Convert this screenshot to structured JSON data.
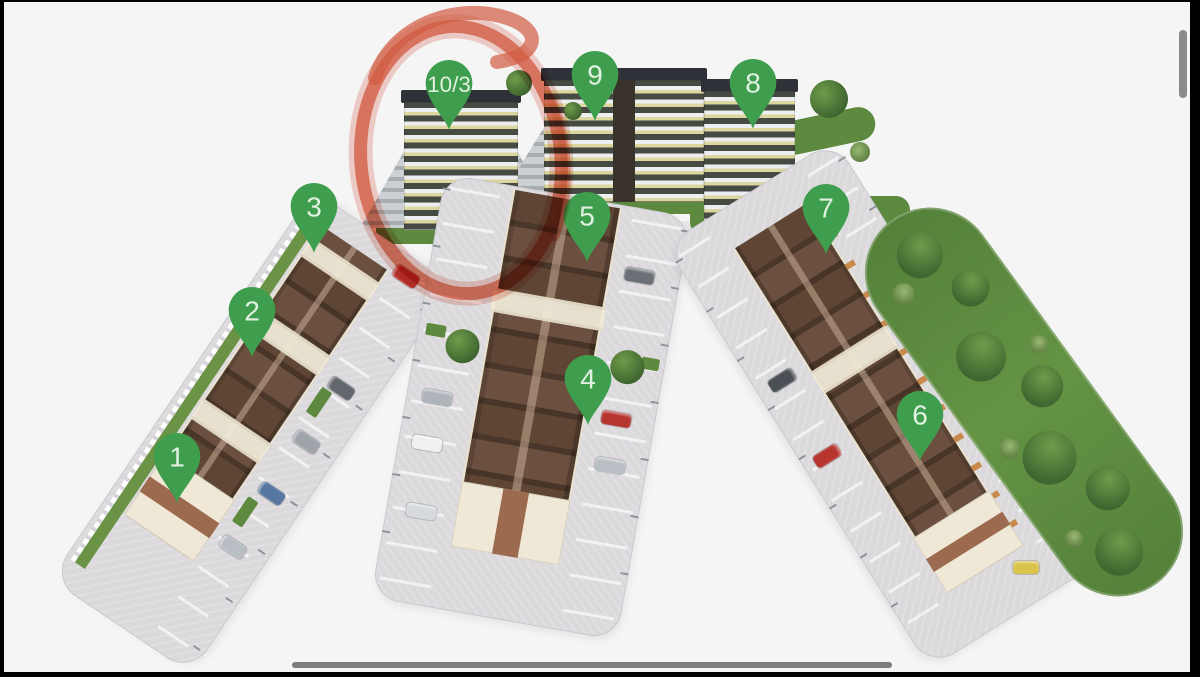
{
  "pins": [
    {
      "label": "1"
    },
    {
      "label": "2"
    },
    {
      "label": "3"
    },
    {
      "label": "4"
    },
    {
      "label": "5"
    },
    {
      "label": "6"
    },
    {
      "label": "7"
    },
    {
      "label": "8"
    },
    {
      "label": "9"
    },
    {
      "label": "10/3"
    }
  ],
  "highlight": {
    "shape": "hand-drawn-marker-circle",
    "target_pin": "10/3"
  },
  "colors": {
    "background": "#f6f5f6",
    "frame": "#000000",
    "pin": "#3f9e4d",
    "pin_text": "#e7f4e7",
    "highlight": "#d95f43",
    "parking": "#dbd9dc",
    "roof": "#5a4130",
    "gable": "#efe8d6",
    "brick": "#9c6a4f",
    "lawn": "#5d8a3e",
    "tree": "#3f6530",
    "tower_dark": "#454a42",
    "tower_light": "#eceef0",
    "tower_yellow": "#dcd7a0",
    "tower_roof": "#2e3137",
    "road": "#e7e6e9",
    "scrollbar": "#8b8b8b"
  }
}
